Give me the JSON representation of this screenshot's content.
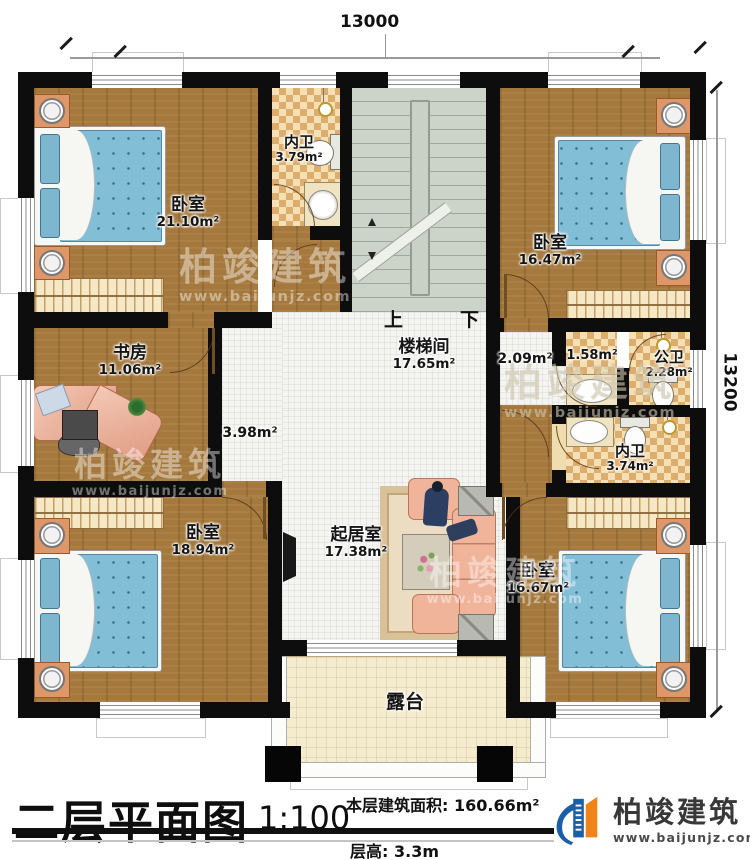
{
  "title_block": {
    "plan_title": "二层平面图",
    "scale": "1:100",
    "area_label": "本层建筑面积:",
    "area_value": "160.66m²",
    "floor_height_label": "层高:",
    "floor_height_value": "3.3m"
  },
  "brand": {
    "name": "柏竣建筑",
    "url": "www.baijunjz.com"
  },
  "dimensions": {
    "width": "13000",
    "height": "13200"
  },
  "stair": {
    "up": "上",
    "down": "下"
  },
  "rooms": [
    {
      "name": "卧室",
      "area": "21.10m²"
    },
    {
      "name": "内卫",
      "area": "3.79m²"
    },
    {
      "name": "卧室",
      "area": "16.47m²"
    },
    {
      "name": "楼梯间",
      "area": "17.65m²"
    },
    {
      "name": "书房",
      "area": "11.06m²"
    },
    {
      "area": "3.98m²"
    },
    {
      "area": "2.09m²"
    },
    {
      "area": "1.58m²"
    },
    {
      "name": "公卫",
      "area": "2.28m²"
    },
    {
      "name": "内卫",
      "area": "3.74m²"
    },
    {
      "name": "卧室",
      "area": "18.94m²"
    },
    {
      "name": "起居室",
      "area": "17.38m²"
    },
    {
      "name": "卧室",
      "area": "16.67m²"
    },
    {
      "name": "露台"
    }
  ],
  "colors": {
    "wall": "#0d0d0d",
    "wood": "#a5793d",
    "checker": "#ddad6e",
    "brand_blue": "#1c5fa8",
    "brand_orange": "#ef8418"
  }
}
